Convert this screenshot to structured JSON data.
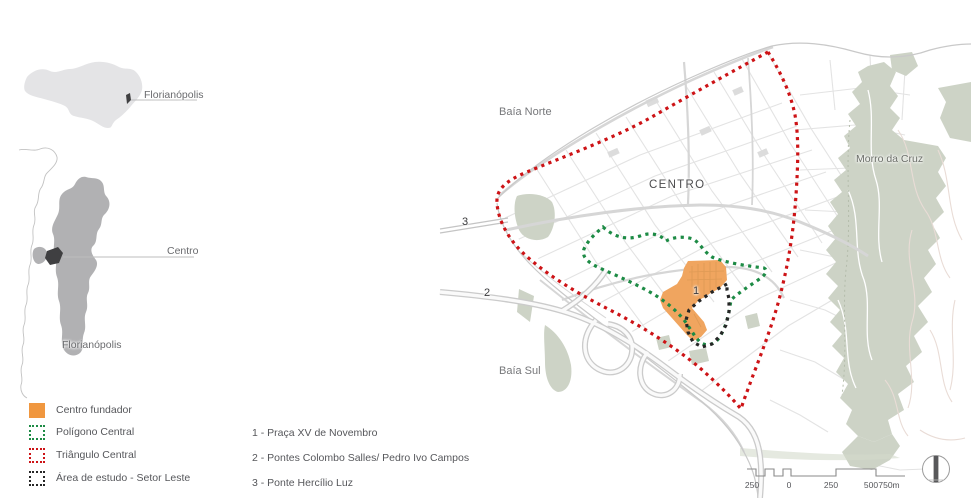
{
  "locator": {
    "state_label": "Florianópolis",
    "centro_label": "Centro",
    "island_label": "Florianópolis"
  },
  "legend": {
    "items": [
      {
        "label": "Centro fundador",
        "swatch": "orange-filled-square",
        "color": "#F0973F",
        "swatch_css": "background:#F0973F;"
      },
      {
        "label": "Polígono Central",
        "swatch": "green-dotted-square",
        "color": "#1D8B45",
        "swatch_css": "border:2.5px dotted #1D8B45;"
      },
      {
        "label": "Triângulo Central",
        "swatch": "red-dotted-square",
        "color": "#CD1316",
        "swatch_css": "border:2.5px dotted #CD1316;"
      },
      {
        "label": "Área de estudo - Setor Leste",
        "swatch": "black-dotted-square",
        "color": "#262626",
        "swatch_css": "border:2.5px dotted #262626;"
      }
    ]
  },
  "notes": [
    "1 - Praça XV de Novembro",
    "2 - Pontes Colombo Salles/ Pedro Ivo Campos",
    "3 - Ponte Hercílio Luz"
  ],
  "map": {
    "labels": {
      "baia_norte": "Baía Norte",
      "centro": "CENTRO",
      "morro_da_cruz": "Morro da Cruz",
      "baia_sul": "Baía Sul",
      "marker_1": "1",
      "marker_2": "2",
      "marker_3": "3"
    },
    "scale_bar": {
      "ticks": [
        "250",
        "0",
        "250",
        "500",
        "750m"
      ]
    },
    "compass": "north-arrow"
  },
  "colors": {
    "state_fill": "#E4E4E6",
    "island_fill": "#B1B1B3",
    "centro_marker": "#3F3F41",
    "streets": "#E3E3E3",
    "major_roads": "#D6D6D6",
    "parks_hills": "#CDD3C6",
    "orange_area": "#F0A55F",
    "red_dotted": "#CD1316",
    "green_dotted": "#1D8B45",
    "black_dotted": "#262626"
  }
}
